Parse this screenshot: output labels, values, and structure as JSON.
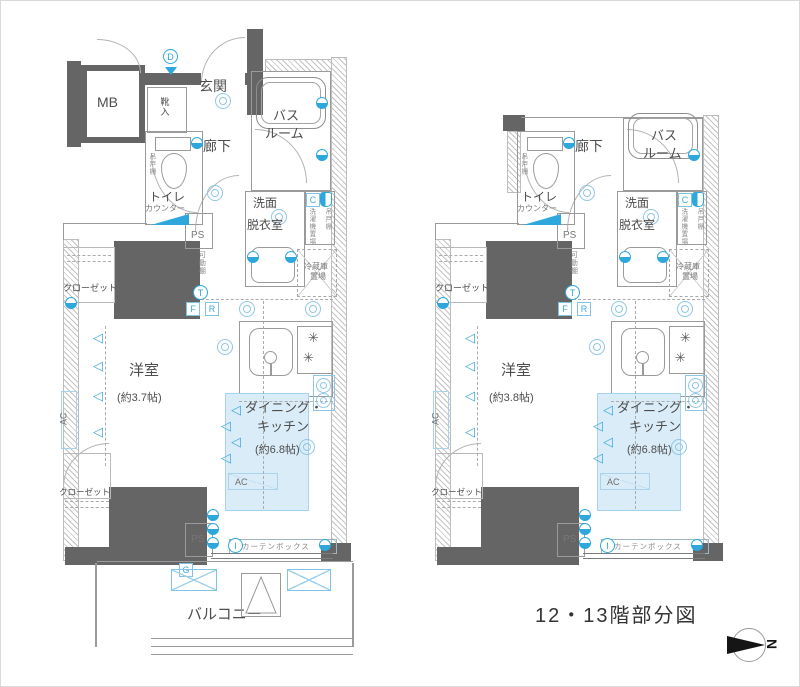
{
  "caption": "12・13階部分図",
  "compass_n": "N",
  "icons": {
    "cone": "◁",
    "burner": "✳"
  },
  "colors": {
    "wall": "#656565",
    "accent_blue": "#2da7dc",
    "dk_fill": "#d9ecf7"
  },
  "plans": {
    "left": {
      "mb": "MB",
      "genkan": "玄関",
      "shoe_box": "靴入",
      "hallway": "廊下",
      "toilet": "トイレ",
      "counter": "カウンター",
      "bath1": "バス",
      "bath2": "ルーム",
      "wash1": "洗面",
      "wash2": "脱衣室",
      "washer": "洗濯機置場",
      "hanging_shelf": "吊戸棚",
      "ps": "PS",
      "movable_shelf": "可動棚",
      "fridge1": "冷蔵庫",
      "fridge2": "置場",
      "closet": "クローゼット",
      "bedroom": "洋室",
      "bedroom_size": "(約3.7帖)",
      "dk1": "ダイニング・",
      "dk2": "キッチン",
      "dk_size": "(約6.8帖)",
      "ac": "AC",
      "curtain": "カーテンボックス",
      "balcony": "バルコニー",
      "m_d": "D",
      "m_c": "C",
      "m_t": "T",
      "m_f": "F",
      "m_r": "R",
      "m_g": "G",
      "m_i": "I"
    },
    "right": {
      "hallway": "廊下",
      "toilet": "トイレ",
      "counter": "カウンター",
      "bath1": "バス",
      "bath2": "ルーム",
      "wash1": "洗面",
      "wash2": "脱衣室",
      "washer": "洗濯機置場",
      "hanging_shelf": "吊戸棚",
      "ps": "PS",
      "movable_shelf": "可動棚",
      "fridge1": "冷蔵庫",
      "fridge2": "置場",
      "closet": "クローゼット",
      "bedroom": "洋室",
      "bedroom_size": "(約3.8帖)",
      "dk1": "ダイニング・",
      "dk2": "キッチン",
      "dk_size": "(約6.8帖)",
      "ac": "AC",
      "curtain": "カーテンボックス",
      "m_c": "C",
      "m_t": "T",
      "m_f": "F",
      "m_r": "R",
      "m_i": "I"
    }
  }
}
